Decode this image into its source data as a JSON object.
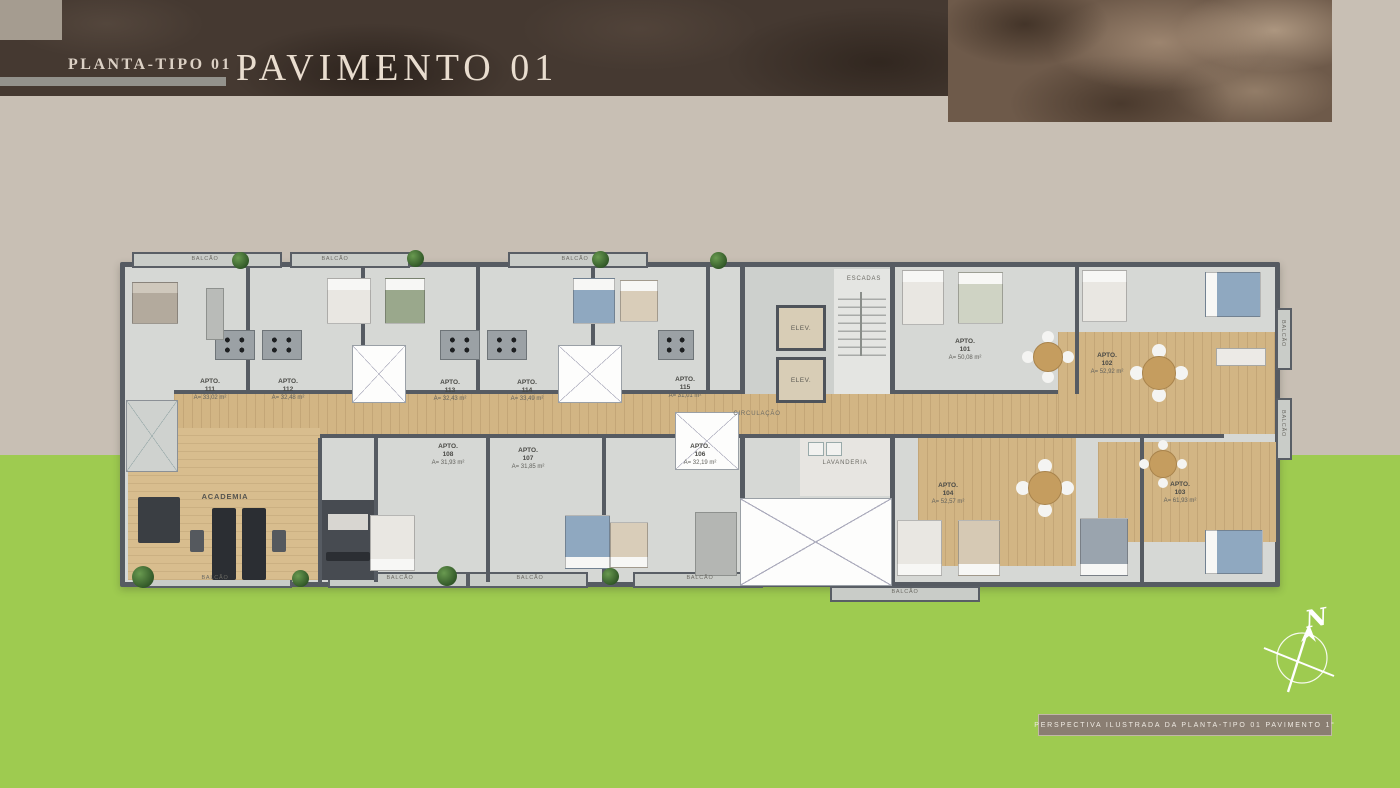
{
  "header": {
    "plan_type_label": "PLANTA-TIPO 01",
    "title": "PAVIMENTO 01"
  },
  "floorplan": {
    "balcony_label": "BALCÃO",
    "rooms": {
      "academia": "ACADEMIA",
      "circulacao": "CIRCULAÇÃO",
      "lavanderia": "LAVANDERIA",
      "escadas": "ESCADAS",
      "elevator": "ELEV."
    },
    "apartments": [
      {
        "label": "APTO.",
        "number": "111",
        "area": "A= 33,02 m²"
      },
      {
        "label": "APTO.",
        "number": "112",
        "area": "A= 32,48 m²"
      },
      {
        "label": "APTO.",
        "number": "113",
        "area": "A= 32,43 m²"
      },
      {
        "label": "APTO.",
        "number": "114",
        "area": "A= 33,49 m²"
      },
      {
        "label": "APTO.",
        "number": "115",
        "area": "A= 31,01 m²"
      },
      {
        "label": "APTO.",
        "number": "108",
        "area": "A= 31,93 m²"
      },
      {
        "label": "APTO.",
        "number": "107",
        "area": "A= 31,85 m²"
      },
      {
        "label": "APTO.",
        "number": "106",
        "area": "A= 32,19 m²"
      },
      {
        "label": "APTO.",
        "number": "101",
        "area": "A= 50,08 m²"
      },
      {
        "label": "APTO.",
        "number": "102",
        "area": "A= 52,92 m²"
      },
      {
        "label": "APTO.",
        "number": "104",
        "area": "A= 52,57 m²"
      },
      {
        "label": "APTO.",
        "number": "103",
        "area": "A= 61,93 m²"
      }
    ]
  },
  "compass": {
    "north_label": "N"
  },
  "footer": {
    "caption": "PERSPECTIVA ILUSTRADA DA PLANTA-TIPO 01 PAVIMENTO 1°"
  },
  "colors": {
    "band_dark": "#453931",
    "band_rock": "#6e5a4a",
    "background_beige": "#c8bfb4",
    "grass_green": "#9ecb50",
    "wall_gray": "#565b62",
    "wood_floor": "#d2b584",
    "title_text": "#e9ddcf"
  }
}
